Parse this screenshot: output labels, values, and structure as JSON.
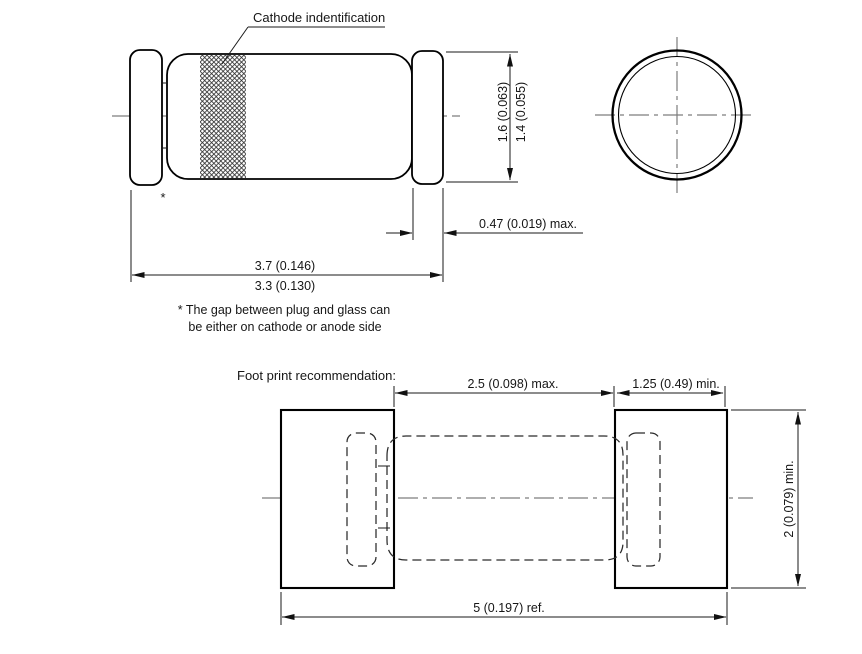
{
  "drawing": {
    "top_view": {
      "cathode_label": "Cathode indentification",
      "gap_marker": "*"
    },
    "dimensions": {
      "body_diameter_max": "1.6 (0.063)",
      "body_diameter_min": "1.4 (0.055)",
      "cap_length": "0.47 (0.019) max.",
      "overall_length_max": "3.7 (0.146)",
      "overall_length_min": "3.3 (0.130)"
    },
    "note": {
      "line1": "* The gap between plug and glass can",
      "line2": "be either on cathode or anode side"
    },
    "footprint": {
      "title": "Foot print recommendation:",
      "pad_gap": "2.5 (0.098) max.",
      "pad_width": "1.25 (0.49) min.",
      "pad_height": "2 (0.079) min.",
      "overall_length": "5 (0.197) ref."
    },
    "colors": {
      "line": "#000000",
      "background": "#ffffff",
      "centerline": "#7d7d7d"
    }
  }
}
